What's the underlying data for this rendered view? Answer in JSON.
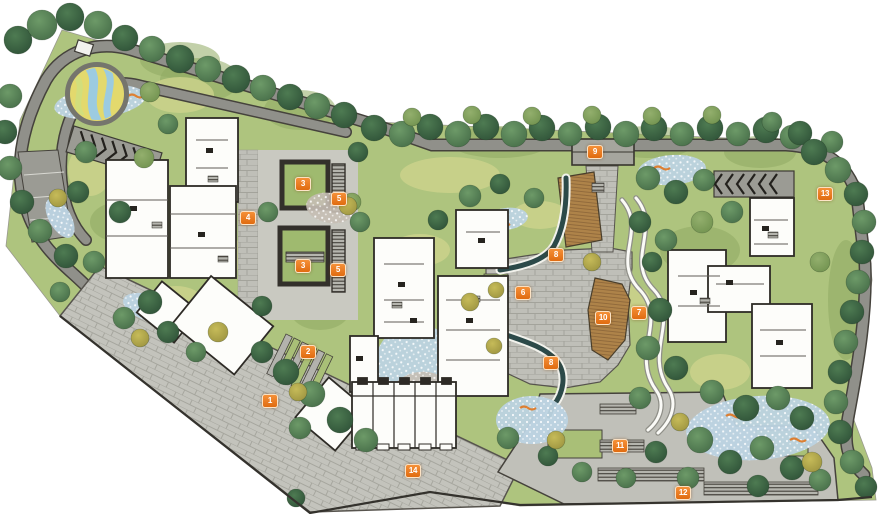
{
  "markers": [
    {
      "label": "1",
      "x": 270,
      "y": 401
    },
    {
      "label": "2",
      "x": 308,
      "y": 352
    },
    {
      "label": "3",
      "x": 303,
      "y": 184
    },
    {
      "label": "3",
      "x": 303,
      "y": 266
    },
    {
      "label": "4",
      "x": 248,
      "y": 218
    },
    {
      "label": "5",
      "x": 339,
      "y": 199
    },
    {
      "label": "5",
      "x": 338,
      "y": 270
    },
    {
      "label": "6",
      "x": 523,
      "y": 293
    },
    {
      "label": "7",
      "x": 639,
      "y": 313
    },
    {
      "label": "8",
      "x": 556,
      "y": 255
    },
    {
      "label": "8",
      "x": 551,
      "y": 363
    },
    {
      "label": "9",
      "x": 595,
      "y": 152
    },
    {
      "label": "10",
      "x": 603,
      "y": 318
    },
    {
      "label": "11",
      "x": 620,
      "y": 446
    },
    {
      "label": "12",
      "x": 683,
      "y": 493
    },
    {
      "label": "13",
      "x": 825,
      "y": 194
    },
    {
      "label": "14",
      "x": 413,
      "y": 471
    }
  ],
  "marker_style": {
    "background": "#ee7a1e",
    "text_color": "#ffffff"
  },
  "palette": {
    "background": "#ffffff",
    "lawn": "#aec47e",
    "lawn_light": "#cdd38c",
    "lawn_dark": "#8fa963",
    "tree_dark": "#3f6b49",
    "tree_mid": "#5b8a5d",
    "tree_light": "#87a766",
    "tree_yellow": "#c2b855",
    "road": "#90908a",
    "paver": "#bfbfb8",
    "deck": "#ae8349",
    "stream": "#2c4a49",
    "shrub_blue": "#bcd3e2",
    "accent_orange": "#e0761f",
    "building_fill": "#fdfdfa",
    "building_line": "#2e2b26",
    "play_yellow": "#e3d96d",
    "play_blue": "#9ccbe0"
  }
}
